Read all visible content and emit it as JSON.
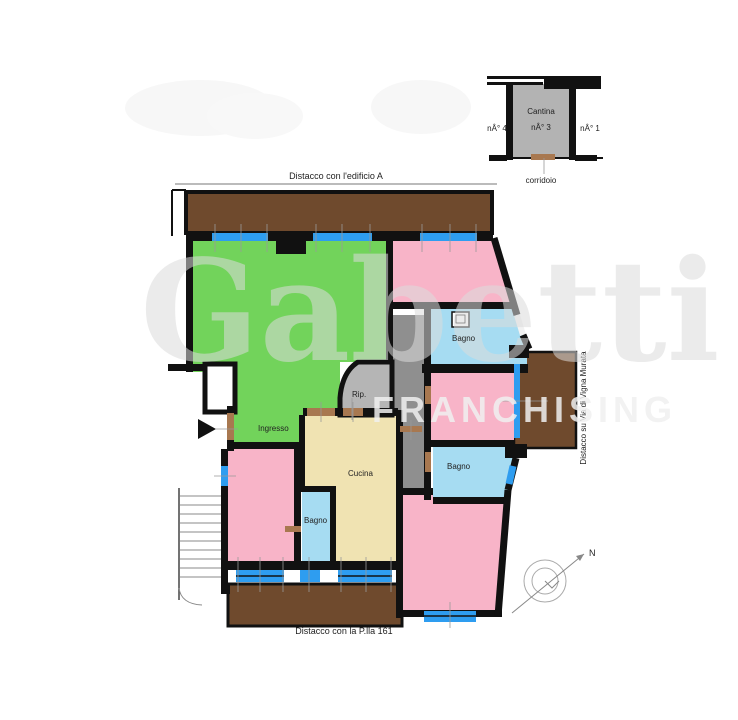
{
  "cellar_inset": {
    "room_label": "Cantina",
    "unit_left": "nÂ° 4",
    "unit_center": "nÂ° 3",
    "unit_right": "nÂ° 1",
    "corridor_label": "corridoio"
  },
  "boundary_labels": {
    "top": "Distacco con l'edificio A",
    "bottom": "Distacco con la P.lla 161",
    "right_vertical": "Distacco su Via di Vigna Murata"
  },
  "room_labels": {
    "entrance": "Ingresso",
    "storage": "Rip.",
    "kitchen": "Cucina",
    "bathroom_upper_right": "Bagno",
    "bathroom_middle_right": "Bagno",
    "bathroom_lower_left": "Bagno"
  },
  "compass": {
    "north_label": "N"
  },
  "watermark": {
    "brand": "Gabetti",
    "subtitle": "FRANCHISING"
  },
  "colors": {
    "wall": "#111111",
    "living_green": "#72d35b",
    "bedroom_pink": "#f8b4c8",
    "bath_blue": "#a6dcf2",
    "kitchen_beige": "#f0e3b2",
    "hall_gray": "#8f8f8f",
    "storage_gray": "#b5b5b5",
    "cellar_gray": "#b3b3b3",
    "balcony_brown": "#6f4a2d",
    "window_blue": "#2e9df0",
    "door_brown": "#a87850"
  }
}
